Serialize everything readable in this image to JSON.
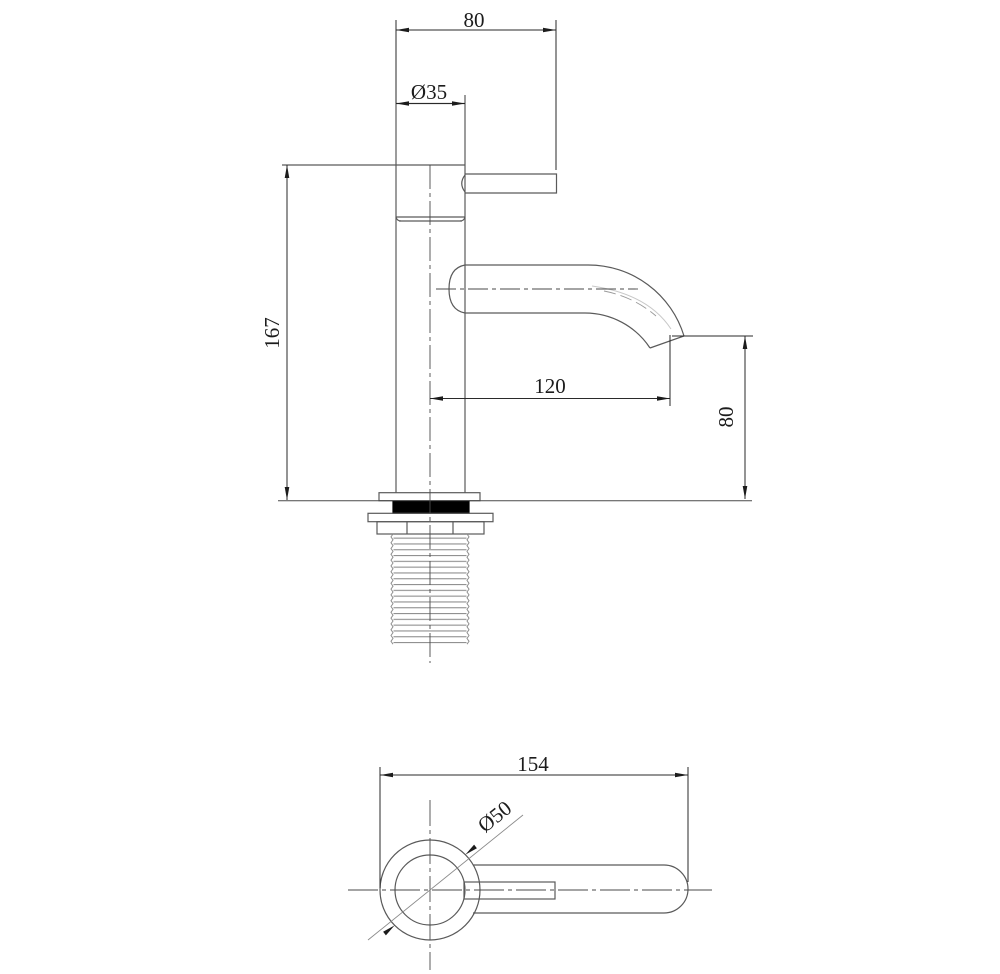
{
  "page": {
    "width": 1000,
    "height": 974,
    "background": "#ffffff"
  },
  "drawing": {
    "subject": "Single-lever basin faucet - dimensioned technical drawing",
    "views": [
      {
        "id": "front-elevation",
        "label": "front elevation"
      },
      {
        "id": "plan-view",
        "label": "plan view"
      }
    ],
    "colors": {
      "part_line": "#5a5a5a",
      "dimension_line": "#2a2a2a",
      "text": "#1c1c1c",
      "centerline": "#4a4a4a",
      "thread_line": "#8f8f8f",
      "washer_fill": "#000000",
      "background": "#ffffff"
    },
    "dimensions": {
      "handle_overall_width": {
        "value": "80",
        "view": "front-elevation",
        "orientation": "horizontal"
      },
      "body_diameter": {
        "value": "Ø35",
        "view": "front-elevation",
        "orientation": "horizontal"
      },
      "overall_height": {
        "value": "167",
        "view": "front-elevation",
        "orientation": "vertical"
      },
      "spout_reach": {
        "value": "120",
        "view": "front-elevation",
        "orientation": "horizontal"
      },
      "spout_outlet_height": {
        "value": "80",
        "view": "front-elevation",
        "orientation": "vertical"
      },
      "overall_length": {
        "value": "154",
        "view": "plan-view",
        "orientation": "horizontal"
      },
      "base_diameter": {
        "value": "Ø50",
        "view": "plan-view",
        "orientation": "diagonal"
      }
    }
  }
}
